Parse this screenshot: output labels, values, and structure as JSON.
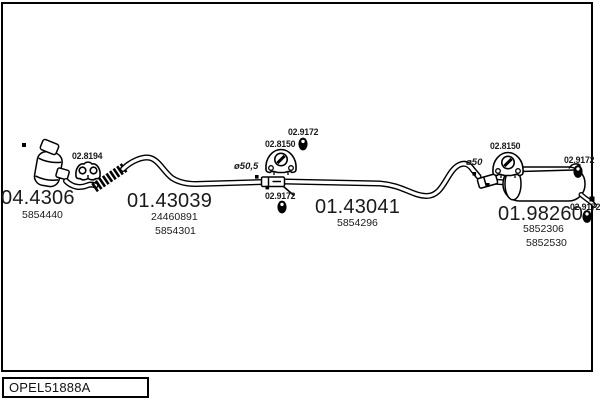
{
  "drawing_code": "OPEL51888A",
  "colors": {
    "background": "#ffffff",
    "line": "#000000",
    "text": "#1a1a1a"
  },
  "parts": [
    {
      "name": "catalytic-converter",
      "code": "04.4306",
      "numbers": [
        "5854440"
      ]
    },
    {
      "name": "front-exhaust-pipe",
      "code": "01.43039",
      "numbers": [
        "24460891",
        "5854301"
      ]
    },
    {
      "name": "centre-exhaust-pipe",
      "code": "01.43041",
      "numbers": [
        "5854296"
      ]
    },
    {
      "name": "rear-silencer",
      "code": "01.98260",
      "numbers": [
        "5852306",
        "5852530"
      ]
    }
  ],
  "fittings": [
    {
      "name": "pipe-clamp",
      "icon": "clamp-icon",
      "code": "02.8194"
    },
    {
      "name": "rubber-mounting-centre",
      "icon": "hanger-icon",
      "code": "02.8150"
    },
    {
      "name": "rubber-grommet-centre-top",
      "icon": "grommet-icon",
      "code": "02.9172"
    },
    {
      "name": "rubber-grommet-centre",
      "icon": "grommet-icon",
      "code": "02.9172"
    },
    {
      "name": "rubber-mounting-rear",
      "icon": "hanger-icon",
      "code": "02.8150"
    },
    {
      "name": "rubber-grommet-rear-top",
      "icon": "grommet-icon",
      "code": "02.9172"
    },
    {
      "name": "rubber-grommet-rear-bottom",
      "icon": "grommet-icon",
      "code": "02.9172"
    }
  ],
  "dimensions": [
    {
      "name": "front-pipe-diameter",
      "label": "ø50,5"
    },
    {
      "name": "centre-pipe-diameter",
      "label": "ø50"
    }
  ]
}
